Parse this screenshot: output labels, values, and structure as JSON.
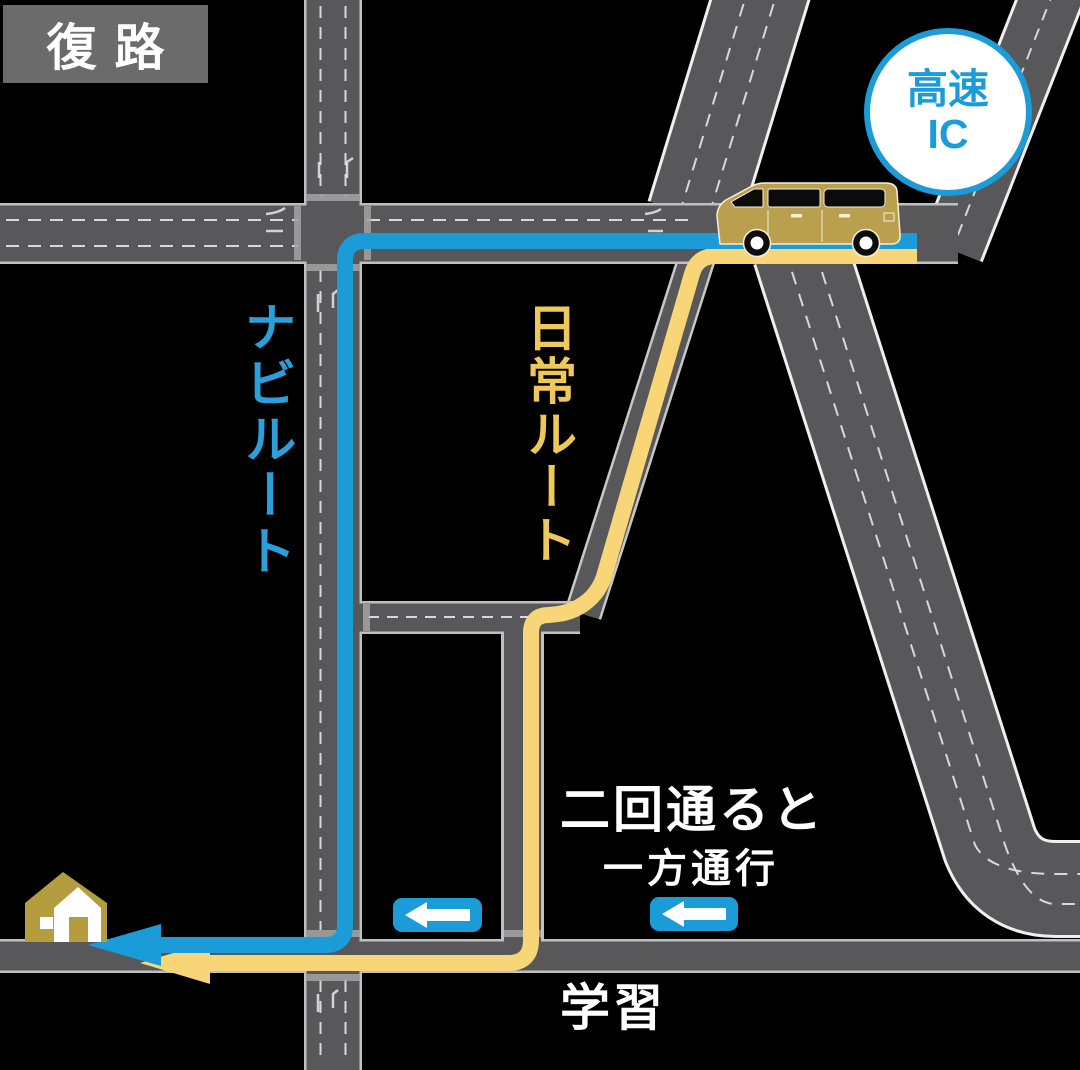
{
  "badge": {
    "label": "復路"
  },
  "ic_badge": {
    "line1": "高速",
    "line2": "IC"
  },
  "labels": {
    "navi_route": "ナビルート",
    "daily_route": "日常ルート",
    "learn_line1": "二回通ると",
    "learn_line2": "学習",
    "one_way": "一方通行"
  },
  "colors": {
    "background": "#000000",
    "road_gray": "#58585a",
    "road_edge": "#c0c0c0",
    "route_blue": "#1b9cd8",
    "route_yellow": "#f8d678",
    "navi_label_blue": "#2b9fd9",
    "daily_label_yellow": "#eec85a",
    "vehicle_gold": "#b99f4e",
    "badge_gray": "#6b6b6b"
  },
  "icons": {
    "car": "car-icon",
    "house": "house-icon",
    "one_way_sign": "left-arrow-icon",
    "highway_ic_badge": "highway-ic-badge"
  }
}
